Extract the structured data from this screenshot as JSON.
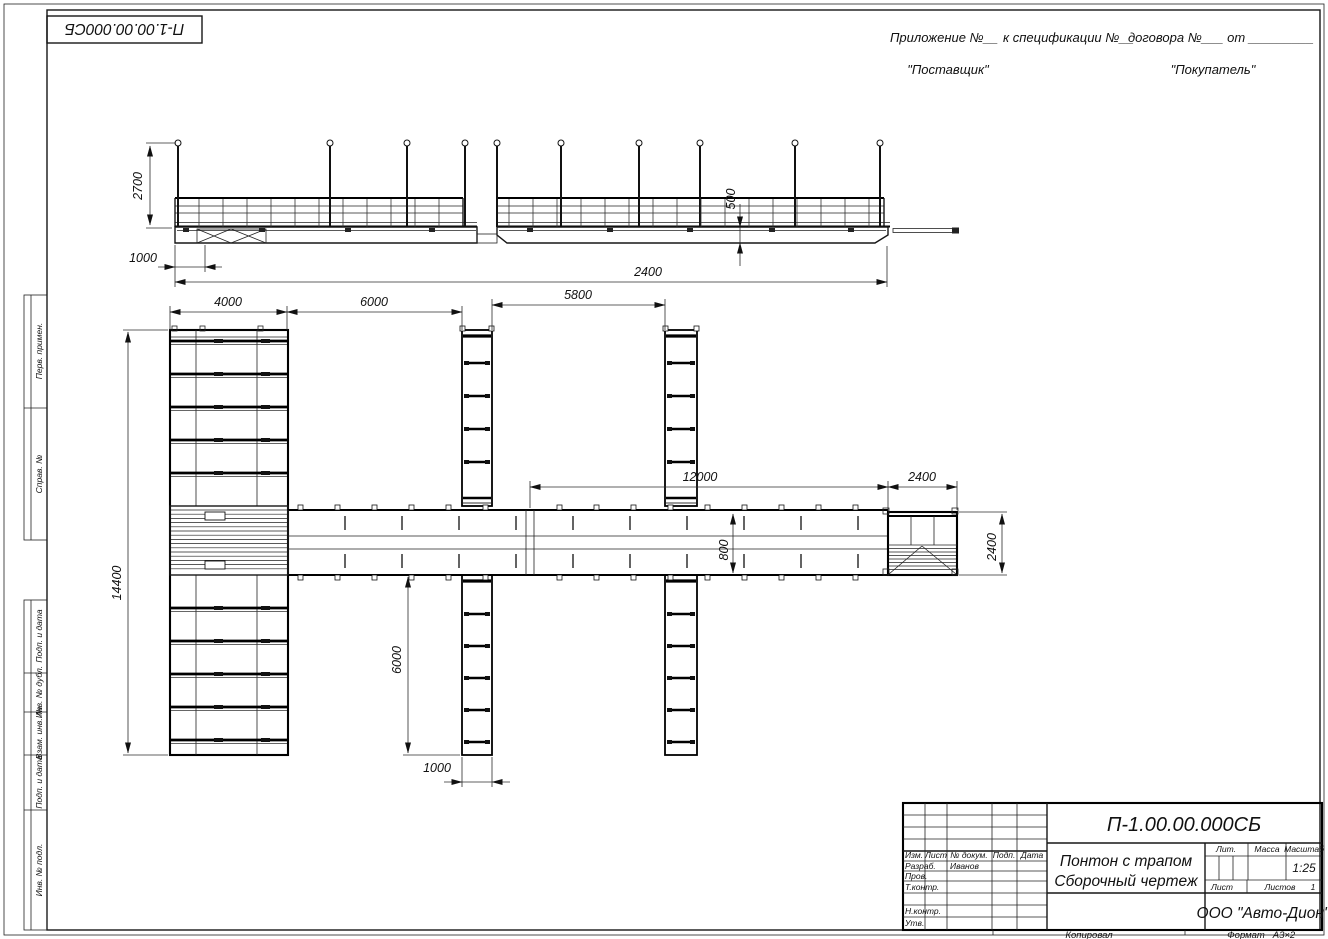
{
  "corner_stamp": {
    "doc_number": "П-1.00.00.000СБ"
  },
  "header_note": {
    "appendix": "Приложение №__",
    "to_spec": "к спецификации №__",
    "contract": "договора №___  от _________",
    "supplier": "\"Поставщик\"",
    "buyer": "\"Покупатель\""
  },
  "margin_stamps": {
    "labels": [
      "Перв. примен.",
      "Справ. №",
      "Подп. и дата",
      "Инв. № дубл.",
      "Взам. инв. №",
      "Подп. и дата",
      "Инв. № подл."
    ]
  },
  "dims": {
    "post_height": "2700",
    "bow_offset": "1000",
    "overall_length": "2400",
    "freeboard": "500",
    "left_block_width": "4000",
    "bay_1": "6000",
    "bay_2": "5800",
    "walkway_length": "12000",
    "end_platform_width": "2400",
    "left_block_length": "14400",
    "finger_length": "6000",
    "finger_width": "1000",
    "walkway_width": "800",
    "end_platform_depth": "2400"
  },
  "title_block": {
    "doc_number": "П-1.00.00.000СБ",
    "name_line1": "Понтон с трапом",
    "name_line2": "Сборочный чертеж",
    "company": "ООО \"Авто-Дион\"",
    "scale_value": "1:25",
    "cols": {
      "izm": "Изм.",
      "list": "Лист",
      "doc": "№ докум.",
      "podp": "Подп.",
      "data": "Дата"
    },
    "rows": {
      "razrab": "Разраб.",
      "prov": "Пров.",
      "tkontr": "Т.контр.",
      "nkontr": "Н.контр.",
      "utv": "Утв."
    },
    "names": {
      "razrab_name": "Иванов"
    },
    "labels": {
      "lit": "Лит.",
      "massa": "Масса",
      "masshtab": "Масштаб",
      "list": "Лист",
      "listov": "Листов",
      "listov_value": "1"
    }
  },
  "footer": {
    "kopiroval": "Копировал",
    "format_label": "Формат",
    "format_value": "А3×2"
  }
}
